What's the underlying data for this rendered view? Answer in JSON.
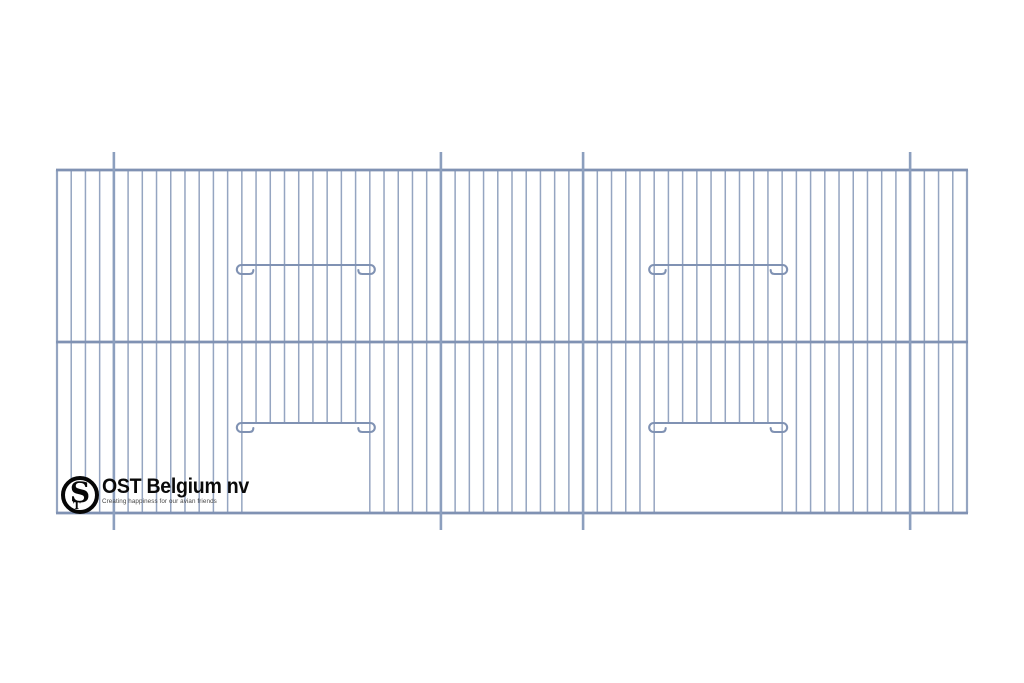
{
  "canvas": {
    "width": 1024,
    "height": 683,
    "background": "#ffffff"
  },
  "brand": {
    "name": "OST Belgium nv",
    "tagline": "Creating happiness for our avian friends",
    "monogram": {
      "large": "S",
      "small": "T"
    },
    "ring_color": "#060606",
    "text_color": "#0a0a0a",
    "tagline_color": "#474747"
  },
  "drawing": {
    "subject": "wire-cage-front-panel",
    "colors": {
      "wire": "#95a5c1",
      "rail": "#8092b3",
      "post": "#8c9fbe",
      "hook": "#8092b3"
    },
    "panel": {
      "left": 57,
      "right": 967,
      "top": 170,
      "bottom": 513
    },
    "grid": {
      "columns": 64,
      "wire_width": 1.5,
      "edge_wire_width": 2.2
    },
    "rails": {
      "ys": [
        170,
        342,
        513
      ],
      "width": 2.8,
      "overhang": 1
    },
    "posts": {
      "columns": [
        4,
        27,
        37,
        60
      ],
      "top_y": 152,
      "bottom_y": 530,
      "width": 2.6
    },
    "doors": [
      {
        "left_col": 13,
        "right_col": 22,
        "slide_hook_y": 265,
        "door_hook_y": 423
      },
      {
        "left_col": 42,
        "right_col": 51,
        "slide_hook_y": 265,
        "door_hook_y": 423
      }
    ],
    "hook": {
      "overhang": 5,
      "radius": 4.5,
      "return_len": 12,
      "tick": 4,
      "width": 2.1
    }
  }
}
